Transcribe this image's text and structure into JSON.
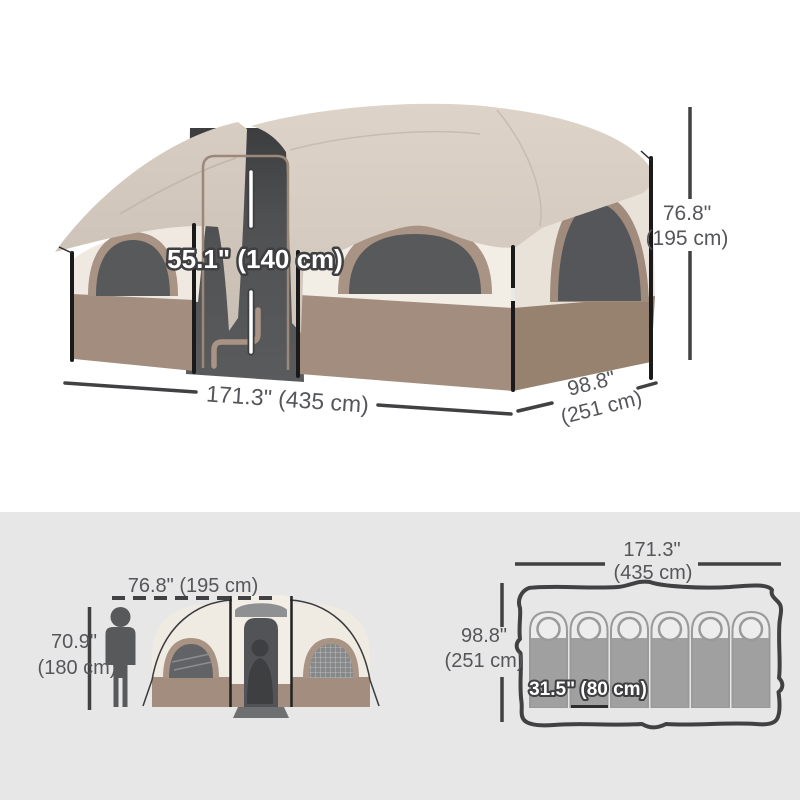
{
  "main_view": {
    "door_height_label": "55.1\" (140 cm)",
    "height_label": "76.8\"",
    "height_metric": "(195 cm)",
    "width_label": "171.3\" (435 cm)",
    "depth_label": "98.8\"",
    "depth_metric": "(251 cm)"
  },
  "side_view": {
    "width_label": "76.8\" (195 cm)",
    "person_height_label": "70.9\"",
    "person_height_metric": "(180 cm)"
  },
  "floor_plan": {
    "width_label": "171.3\"",
    "width_metric": "(435 cm)",
    "depth_label": "98.8\"",
    "depth_metric": "(251 cm)",
    "sleeping_bag_label": "31.5\" (80 cm)",
    "sleeping_bag_count": 6
  },
  "colors": {
    "canopy_beige": "#d6ccc0",
    "wall_cream": "#f2ede5",
    "wall_brown": "#a28d7f",
    "trim_taupe": "#a89384",
    "window_dark": "#58595b",
    "annotation_gray": "#414042",
    "background_gray": "#e7e7e7"
  }
}
